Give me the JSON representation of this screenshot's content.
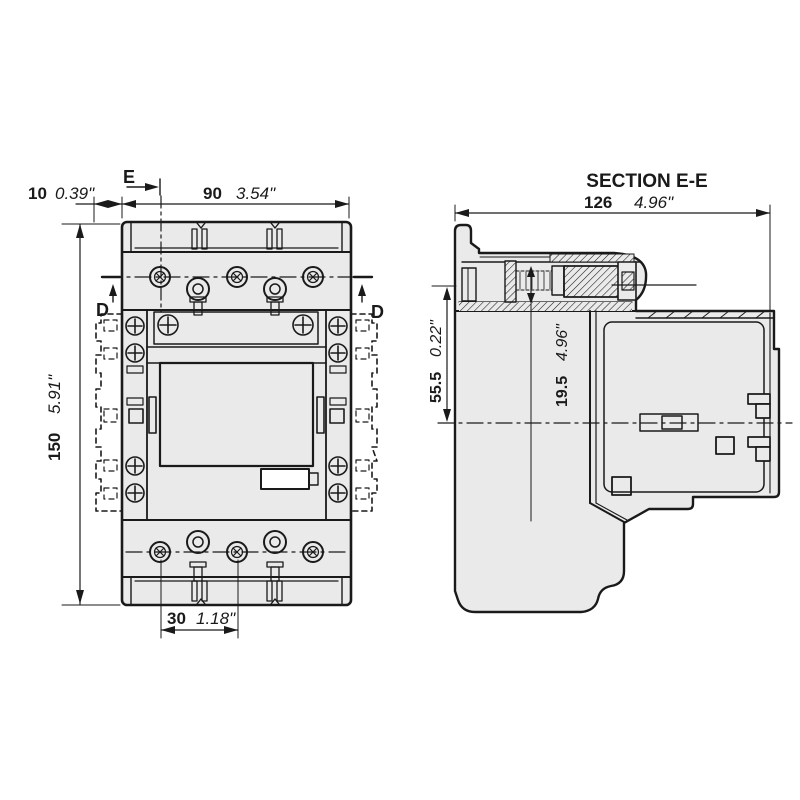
{
  "colors": {
    "background": "#ffffff",
    "line": "#1a1a1a",
    "body_fill": "#eaeaea"
  },
  "front_view": {
    "marker_e": "E",
    "marker_d_left": "D",
    "marker_d_right": "D",
    "dim_side_offset": {
      "mm": "10",
      "inch": "0.39\""
    },
    "dim_width": {
      "mm": "90",
      "inch": "3.54\""
    },
    "dim_height": {
      "mm": "150",
      "inch": "5.91\""
    },
    "dim_pole_pitch": {
      "mm": "30",
      "inch": "1.18\""
    }
  },
  "section_view": {
    "title": "SECTION E-E",
    "dim_depth": {
      "mm": "126",
      "inch": "4.96\""
    },
    "dim_axis_height": {
      "mm": "55.5",
      "inch": "0.22\""
    },
    "dim_travel": {
      "mm": "19.5",
      "inch": "4.96\""
    }
  }
}
